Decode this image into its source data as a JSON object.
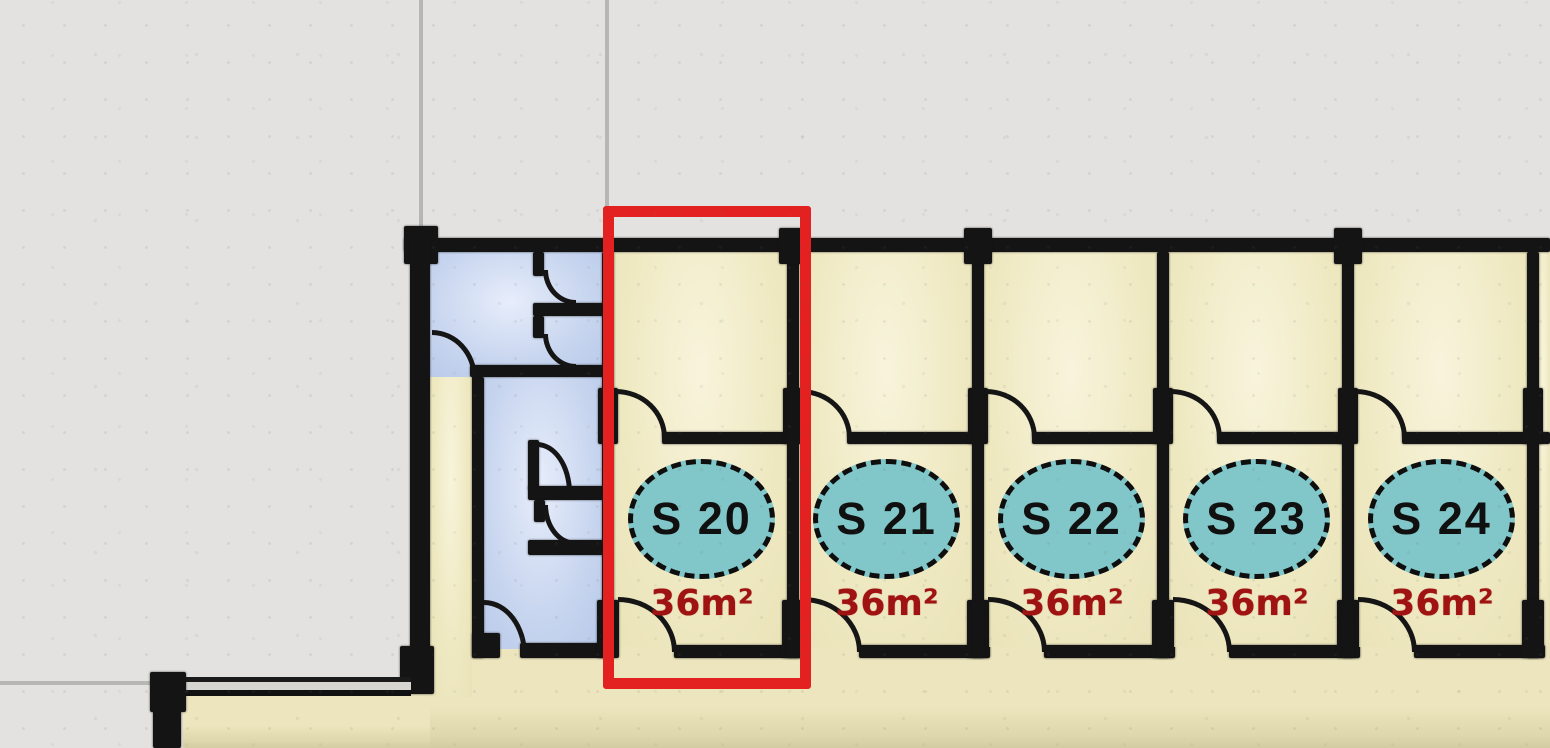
{
  "plan_type": "storage units floor plan",
  "units": [
    {
      "label": "S 20",
      "area": "36m²",
      "highlighted": true
    },
    {
      "label": "S 21",
      "area": "36m²",
      "highlighted": false
    },
    {
      "label": "S 22",
      "area": "36m²",
      "highlighted": false
    },
    {
      "label": "S 23",
      "area": "36m²",
      "highlighted": false
    },
    {
      "label": "S 24",
      "area": "36m²",
      "highlighted": false
    }
  ],
  "selected_unit": "S 20",
  "colors": {
    "background": "#e3e2e0",
    "wall": "#141414",
    "unit_floor": "#efe9c2",
    "utility_floor": "#c6d4ee",
    "corridor_floor": "#ece5bd",
    "label_ellipse_fill": "#81c6c8",
    "label_text": "#101010",
    "area_text": "#a01313",
    "highlight": "#e32120"
  }
}
